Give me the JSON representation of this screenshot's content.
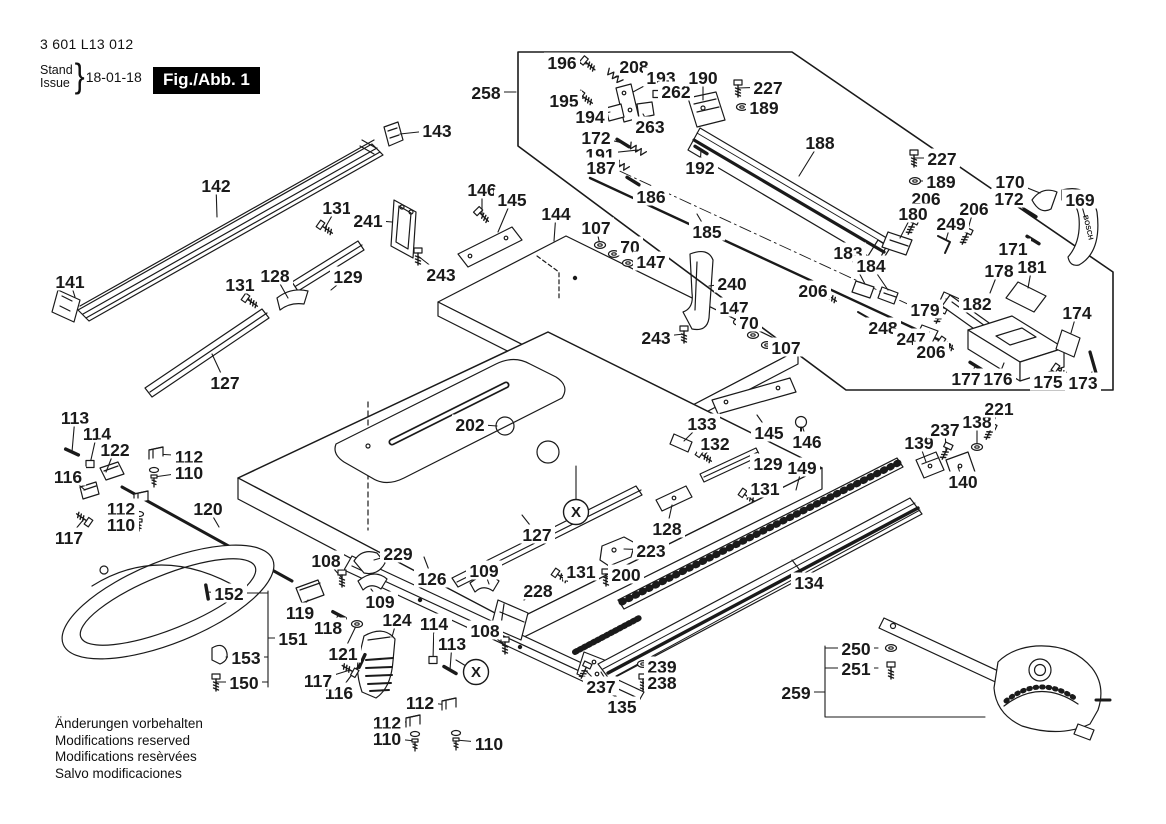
{
  "header": {
    "part_number": "3 601 L13 012",
    "stand_label": "Stand",
    "issue_label": "Issue",
    "brace": "}",
    "date": "18-01-18",
    "figure_label": "Fig./Abb. 1"
  },
  "footer": {
    "lines": [
      "Änderungen vorbehalten",
      "Modifications reserved",
      "Modifications resèrvées",
      "Salvo modificaciones"
    ]
  },
  "diagram": {
    "brand_text": "BOSCH",
    "line_color": "#1a1a1a",
    "background": "#ffffff",
    "callout_marker": "X"
  },
  "callouts": [
    {
      "n": "258",
      "x": 486,
      "y": 92,
      "t": [
        516,
        92
      ]
    },
    {
      "n": "196",
      "x": 562,
      "y": 62,
      "t": [
        588,
        64
      ],
      "icon": "screw",
      "rot": 40
    },
    {
      "n": "208",
      "x": 634,
      "y": 66,
      "t": [
        615,
        77
      ],
      "icon": "spring",
      "rot": 40
    },
    {
      "n": "193",
      "x": 661,
      "y": 77,
      "t": [
        633,
        92
      ]
    },
    {
      "n": "262",
      "x": 676,
      "y": 91,
      "t": [
        657,
        94
      ],
      "icon": "nut"
    },
    {
      "n": "190",
      "x": 703,
      "y": 77,
      "t": [
        703,
        100
      ]
    },
    {
      "n": "227",
      "x": 768,
      "y": 87,
      "t": [
        738,
        88
      ],
      "icon": "screwv"
    },
    {
      "n": "189",
      "x": 764,
      "y": 107,
      "t": [
        742,
        107
      ],
      "icon": "washer"
    },
    {
      "n": "195",
      "x": 564,
      "y": 100,
      "t": [
        585,
        98
      ],
      "icon": "screw",
      "rot": 35
    },
    {
      "n": "194",
      "x": 590,
      "y": 116,
      "t": [
        610,
        112
      ]
    },
    {
      "n": "263",
      "x": 650,
      "y": 126,
      "t": [
        643,
        114
      ]
    },
    {
      "n": "172",
      "x": 596,
      "y": 137,
      "t": [
        623,
        143
      ],
      "icon": "pin",
      "rot": 32
    },
    {
      "n": "191",
      "x": 600,
      "y": 154,
      "t": [
        638,
        150
      ],
      "icon": "spring",
      "rot": 32
    },
    {
      "n": "187",
      "x": 601,
      "y": 167,
      "t": [
        621,
        165
      ],
      "icon": "spring",
      "rot": 32
    },
    {
      "n": "186",
      "x": 651,
      "y": 196,
      "t": [
        633,
        181
      ],
      "icon": "pin",
      "rot": 32
    },
    {
      "n": "192",
      "x": 700,
      "y": 167,
      "t": [
        701,
        150
      ],
      "icon": "pin",
      "rot": 32
    },
    {
      "n": "188",
      "x": 820,
      "y": 142,
      "t": [
        799,
        176
      ]
    },
    {
      "n": "185",
      "x": 707,
      "y": 231,
      "t": [
        697,
        214
      ]
    },
    {
      "n": "227",
      "x": 942,
      "y": 158,
      "t": [
        914,
        158
      ],
      "icon": "screwv"
    },
    {
      "n": "189",
      "x": 941,
      "y": 181,
      "t": [
        915,
        181
      ],
      "icon": "washer"
    },
    {
      "n": "206",
      "x": 926,
      "y": 198,
      "t": [
        912,
        226
      ],
      "icon": "screw",
      "rot": 115
    },
    {
      "n": "180",
      "x": 913,
      "y": 213,
      "t": [
        900,
        238
      ]
    },
    {
      "n": "249",
      "x": 951,
      "y": 223,
      "t": [
        946,
        240
      ]
    },
    {
      "n": "206",
      "x": 974,
      "y": 208,
      "t": [
        966,
        236
      ],
      "icon": "screw",
      "rot": 115
    },
    {
      "n": "170",
      "x": 1010,
      "y": 181,
      "t": [
        1040,
        193
      ]
    },
    {
      "n": "172",
      "x": 1009,
      "y": 198,
      "t": [
        1030,
        213
      ],
      "icon": "pin",
      "rot": 32
    },
    {
      "n": "169",
      "x": 1080,
      "y": 199,
      "t": [
        1085,
        217
      ]
    },
    {
      "n": "171",
      "x": 1013,
      "y": 248,
      "t": [
        1033,
        240
      ],
      "icon": "pin",
      "rot": 32
    },
    {
      "n": "183",
      "x": 848,
      "y": 252,
      "t": [
        865,
        284
      ]
    },
    {
      "n": "184",
      "x": 871,
      "y": 265,
      "t": [
        888,
        290
      ]
    },
    {
      "n": "178",
      "x": 999,
      "y": 270,
      "t": [
        990,
        293
      ]
    },
    {
      "n": "181",
      "x": 1032,
      "y": 266,
      "t": [
        1028,
        288
      ]
    },
    {
      "n": "182",
      "x": 977,
      "y": 303,
      "t": [
        958,
        301
      ]
    },
    {
      "n": "179",
      "x": 925,
      "y": 309,
      "t": [
        940,
        315
      ],
      "icon": "screw",
      "rot": 115
    },
    {
      "n": "248",
      "x": 883,
      "y": 327,
      "t": [
        871,
        320
      ]
    },
    {
      "n": "247",
      "x": 911,
      "y": 338,
      "t": [
        929,
        332
      ]
    },
    {
      "n": "206",
      "x": 931,
      "y": 351,
      "t": [
        946,
        344
      ],
      "icon": "screw",
      "rot": 35
    },
    {
      "n": "174",
      "x": 1077,
      "y": 312,
      "t": [
        1071,
        333
      ]
    },
    {
      "n": "177",
      "x": 966,
      "y": 378,
      "t": [
        976,
        366
      ],
      "icon": "pin",
      "rot": 32
    },
    {
      "n": "176",
      "x": 998,
      "y": 378,
      "t": [
        1004,
        363
      ]
    },
    {
      "n": "175",
      "x": 1048,
      "y": 381,
      "t": [
        1060,
        371
      ],
      "icon": "screw",
      "rot": 35
    },
    {
      "n": "173",
      "x": 1083,
      "y": 382,
      "t": [
        1092,
        372
      ]
    },
    {
      "n": "206",
      "x": 813,
      "y": 290,
      "t": [
        829,
        296
      ],
      "icon": "screw",
      "rot": 35
    },
    {
      "n": "107",
      "x": 786,
      "y": 347,
      "t": [
        767,
        345
      ],
      "icon": "washer"
    },
    {
      "n": "143",
      "x": 437,
      "y": 130,
      "t": [
        400,
        134
      ]
    },
    {
      "n": "142",
      "x": 216,
      "y": 185,
      "t": [
        217,
        217
      ]
    },
    {
      "n": "131",
      "x": 337,
      "y": 207,
      "t": [
        325,
        228
      ],
      "icon": "screw",
      "rot": 35
    },
    {
      "n": "241",
      "x": 368,
      "y": 220,
      "t": [
        392,
        222
      ]
    },
    {
      "n": "146",
      "x": 482,
      "y": 189,
      "t": [
        482,
        215
      ],
      "icon": "screw",
      "rot": 45
    },
    {
      "n": "145",
      "x": 512,
      "y": 199,
      "t": [
        498,
        232
      ]
    },
    {
      "n": "144",
      "x": 556,
      "y": 213,
      "t": [
        554,
        241
      ]
    },
    {
      "n": "107",
      "x": 596,
      "y": 227,
      "t": [
        600,
        245
      ],
      "icon": "washer"
    },
    {
      "n": "70",
      "x": 630,
      "y": 246,
      "t": [
        614,
        254
      ],
      "icon": "washer"
    },
    {
      "n": "147",
      "x": 651,
      "y": 261,
      "t": [
        628,
        263
      ],
      "icon": "washer"
    },
    {
      "n": "141",
      "x": 70,
      "y": 281,
      "t": [
        75,
        297
      ]
    },
    {
      "n": "131",
      "x": 240,
      "y": 284,
      "t": [
        250,
        301
      ],
      "icon": "screw",
      "rot": 35
    },
    {
      "n": "128",
      "x": 275,
      "y": 275,
      "t": [
        288,
        298
      ]
    },
    {
      "n": "129",
      "x": 348,
      "y": 276,
      "t": [
        331,
        290
      ]
    },
    {
      "n": "127",
      "x": 225,
      "y": 382,
      "t": [
        212,
        354
      ]
    },
    {
      "n": "243",
      "x": 441,
      "y": 274,
      "t": [
        418,
        256
      ],
      "icon": "screwv"
    },
    {
      "n": "240",
      "x": 732,
      "y": 283,
      "t": [
        709,
        286
      ]
    },
    {
      "n": "147",
      "x": 734,
      "y": 307,
      "t": [
        739,
        322
      ],
      "icon": "washer"
    },
    {
      "n": "70",
      "x": 749,
      "y": 322,
      "t": [
        753,
        335
      ],
      "icon": "washer"
    },
    {
      "n": "243",
      "x": 656,
      "y": 337,
      "t": [
        684,
        334
      ],
      "icon": "screwv"
    },
    {
      "n": "202",
      "x": 470,
      "y": 424,
      "t": [
        497,
        426
      ]
    },
    {
      "n": "133",
      "x": 702,
      "y": 423,
      "t": [
        684,
        441
      ]
    },
    {
      "n": "132",
      "x": 715,
      "y": 443,
      "t": [
        704,
        456
      ],
      "icon": "screw",
      "rot": 35
    },
    {
      "n": "145",
      "x": 769,
      "y": 432,
      "t": [
        757,
        415
      ]
    },
    {
      "n": "146",
      "x": 807,
      "y": 441,
      "t": [
        801,
        422
      ],
      "icon": "ball"
    },
    {
      "n": "129",
      "x": 768,
      "y": 463,
      "t": [
        749,
        468
      ]
    },
    {
      "n": "149",
      "x": 802,
      "y": 467,
      "t": [
        796,
        490
      ]
    },
    {
      "n": "131",
      "x": 765,
      "y": 488,
      "t": [
        747,
        496
      ],
      "icon": "screw",
      "rot": 35
    },
    {
      "n": "128",
      "x": 667,
      "y": 528,
      "t": [
        672,
        505
      ]
    },
    {
      "n": "223",
      "x": 651,
      "y": 550,
      "t": [
        624,
        549
      ]
    },
    {
      "n": "127",
      "x": 537,
      "y": 534,
      "t": [
        522,
        515
      ]
    },
    {
      "n": "131",
      "x": 581,
      "y": 571,
      "t": [
        560,
        576
      ],
      "icon": "screw",
      "rot": 35
    },
    {
      "n": "200",
      "x": 626,
      "y": 574,
      "t": [
        606,
        577
      ],
      "icon": "screwv"
    },
    {
      "n": "228",
      "x": 538,
      "y": 590,
      "t": [
        524,
        600
      ]
    },
    {
      "n": "109",
      "x": 484,
      "y": 570,
      "t": [
        489,
        584
      ]
    },
    {
      "n": "108",
      "x": 485,
      "y": 630,
      "t": [
        505,
        645
      ],
      "icon": "screwv"
    },
    {
      "n": "113",
      "x": 452,
      "y": 643,
      "t": [
        450,
        670
      ],
      "icon": "pin",
      "rot": 30
    },
    {
      "n": "114",
      "x": 434,
      "y": 623,
      "t": [
        433,
        660
      ],
      "icon": "nut"
    },
    {
      "n": "124",
      "x": 397,
      "y": 619,
      "t": [
        392,
        637
      ]
    },
    {
      "n": "121",
      "x": 343,
      "y": 653,
      "t": [
        357,
        624
      ],
      "icon": "washer"
    },
    {
      "n": "116",
      "x": 339,
      "y": 692,
      "t": [
        362,
        661
      ],
      "icon": "pin",
      "rot": 115
    },
    {
      "n": "117",
      "x": 318,
      "y": 680,
      "t": [
        350,
        670
      ],
      "icon": "screw",
      "rot": 210
    },
    {
      "n": "118",
      "x": 328,
      "y": 627,
      "t": [
        339,
        615
      ],
      "icon": "pin",
      "rot": 28
    },
    {
      "n": "119",
      "x": 300,
      "y": 612,
      "t": [
        308,
        600
      ]
    },
    {
      "n": "151",
      "x": 293,
      "y": 638,
      "t": [
        281,
        638
      ]
    },
    {
      "n": "152",
      "x": 229,
      "y": 593,
      "t": [
        207,
        592
      ],
      "icon": "pin",
      "rot": 80
    },
    {
      "n": "153",
      "x": 246,
      "y": 657,
      "t": [
        226,
        657
      ]
    },
    {
      "n": "150",
      "x": 244,
      "y": 682,
      "t": [
        216,
        682
      ],
      "icon": "screwv"
    },
    {
      "n": "120",
      "x": 208,
      "y": 508,
      "t": [
        219,
        527
      ]
    },
    {
      "n": "112",
      "x": 189,
      "y": 456,
      "t": [
        156,
        454
      ],
      "icon": "clip"
    },
    {
      "n": "110",
      "x": 189,
      "y": 472,
      "t": [
        154,
        477
      ],
      "icon": "boltv"
    },
    {
      "n": "112",
      "x": 121,
      "y": 508,
      "t": [
        141,
        498
      ],
      "icon": "clip"
    },
    {
      "n": "110",
      "x": 121,
      "y": 524,
      "t": [
        139,
        521
      ],
      "icon": "boltv"
    },
    {
      "n": "113",
      "x": 75,
      "y": 417,
      "t": [
        72,
        452
      ],
      "icon": "pin",
      "rot": 25
    },
    {
      "n": "114",
      "x": 97,
      "y": 433,
      "t": [
        90,
        464
      ],
      "icon": "nut"
    },
    {
      "n": "122",
      "x": 115,
      "y": 449,
      "t": [
        106,
        472
      ]
    },
    {
      "n": "116",
      "x": 68,
      "y": 476,
      "t": [
        85,
        490
      ]
    },
    {
      "n": "117",
      "x": 69,
      "y": 537,
      "t": [
        84,
        519
      ],
      "icon": "screw",
      "rot": 215
    },
    {
      "n": "108",
      "x": 326,
      "y": 560,
      "t": [
        342,
        578
      ],
      "icon": "screwv"
    },
    {
      "n": "229",
      "x": 398,
      "y": 553,
      "t": [
        374,
        560
      ]
    },
    {
      "n": "126",
      "x": 432,
      "y": 578,
      "t": [
        424,
        557
      ]
    },
    {
      "n": "109",
      "x": 380,
      "y": 601,
      "t": [
        371,
        589
      ]
    },
    {
      "n": "112",
      "x": 420,
      "y": 702,
      "t": [
        449,
        705
      ],
      "icon": "clip"
    },
    {
      "n": "112",
      "x": 387,
      "y": 722,
      "t": [
        413,
        722
      ],
      "icon": "clip"
    },
    {
      "n": "110",
      "x": 387,
      "y": 738,
      "t": [
        415,
        741
      ],
      "icon": "boltv"
    },
    {
      "n": "110",
      "x": 489,
      "y": 743,
      "t": [
        456,
        740
      ],
      "icon": "boltv"
    },
    {
      "n": "135",
      "x": 622,
      "y": 706,
      "t": [
        601,
        672
      ]
    },
    {
      "n": "237",
      "x": 601,
      "y": 686,
      "t": [
        585,
        670
      ],
      "icon": "screw",
      "rot": 115
    },
    {
      "n": "239",
      "x": 662,
      "y": 666,
      "t": [
        643,
        664
      ],
      "icon": "washer"
    },
    {
      "n": "238",
      "x": 662,
      "y": 682,
      "t": [
        643,
        682
      ],
      "icon": "screwv"
    },
    {
      "n": "134",
      "x": 809,
      "y": 582,
      "t": [
        792,
        560
      ]
    },
    {
      "n": "139",
      "x": 919,
      "y": 442,
      "t": [
        926,
        462
      ]
    },
    {
      "n": "237",
      "x": 945,
      "y": 429,
      "t": [
        946,
        451
      ],
      "icon": "screw",
      "rot": 115
    },
    {
      "n": "138",
      "x": 977,
      "y": 421,
      "t": [
        977,
        447
      ],
      "icon": "washer"
    },
    {
      "n": "221",
      "x": 999,
      "y": 408,
      "t": [
        990,
        431
      ],
      "icon": "screw",
      "rot": 115
    },
    {
      "n": "140",
      "x": 963,
      "y": 481,
      "t": [
        958,
        467
      ]
    },
    {
      "n": "250",
      "x": 856,
      "y": 648,
      "t": [
        878,
        648
      ],
      "icon": "washer",
      "ip": [
        891,
        648
      ]
    },
    {
      "n": "251",
      "x": 856,
      "y": 668,
      "t": [
        878,
        668
      ],
      "icon": "screwv",
      "ip": [
        891,
        670
      ]
    },
    {
      "n": "259",
      "x": 796,
      "y": 692,
      "t": [
        812,
        692
      ]
    },
    {
      "n": "X",
      "x": 576,
      "y": 512,
      "circle": true,
      "t": [
        576,
        466
      ]
    },
    {
      "n": "X",
      "x": 476,
      "y": 672,
      "circle": true,
      "t": [
        456,
        660
      ]
    }
  ]
}
